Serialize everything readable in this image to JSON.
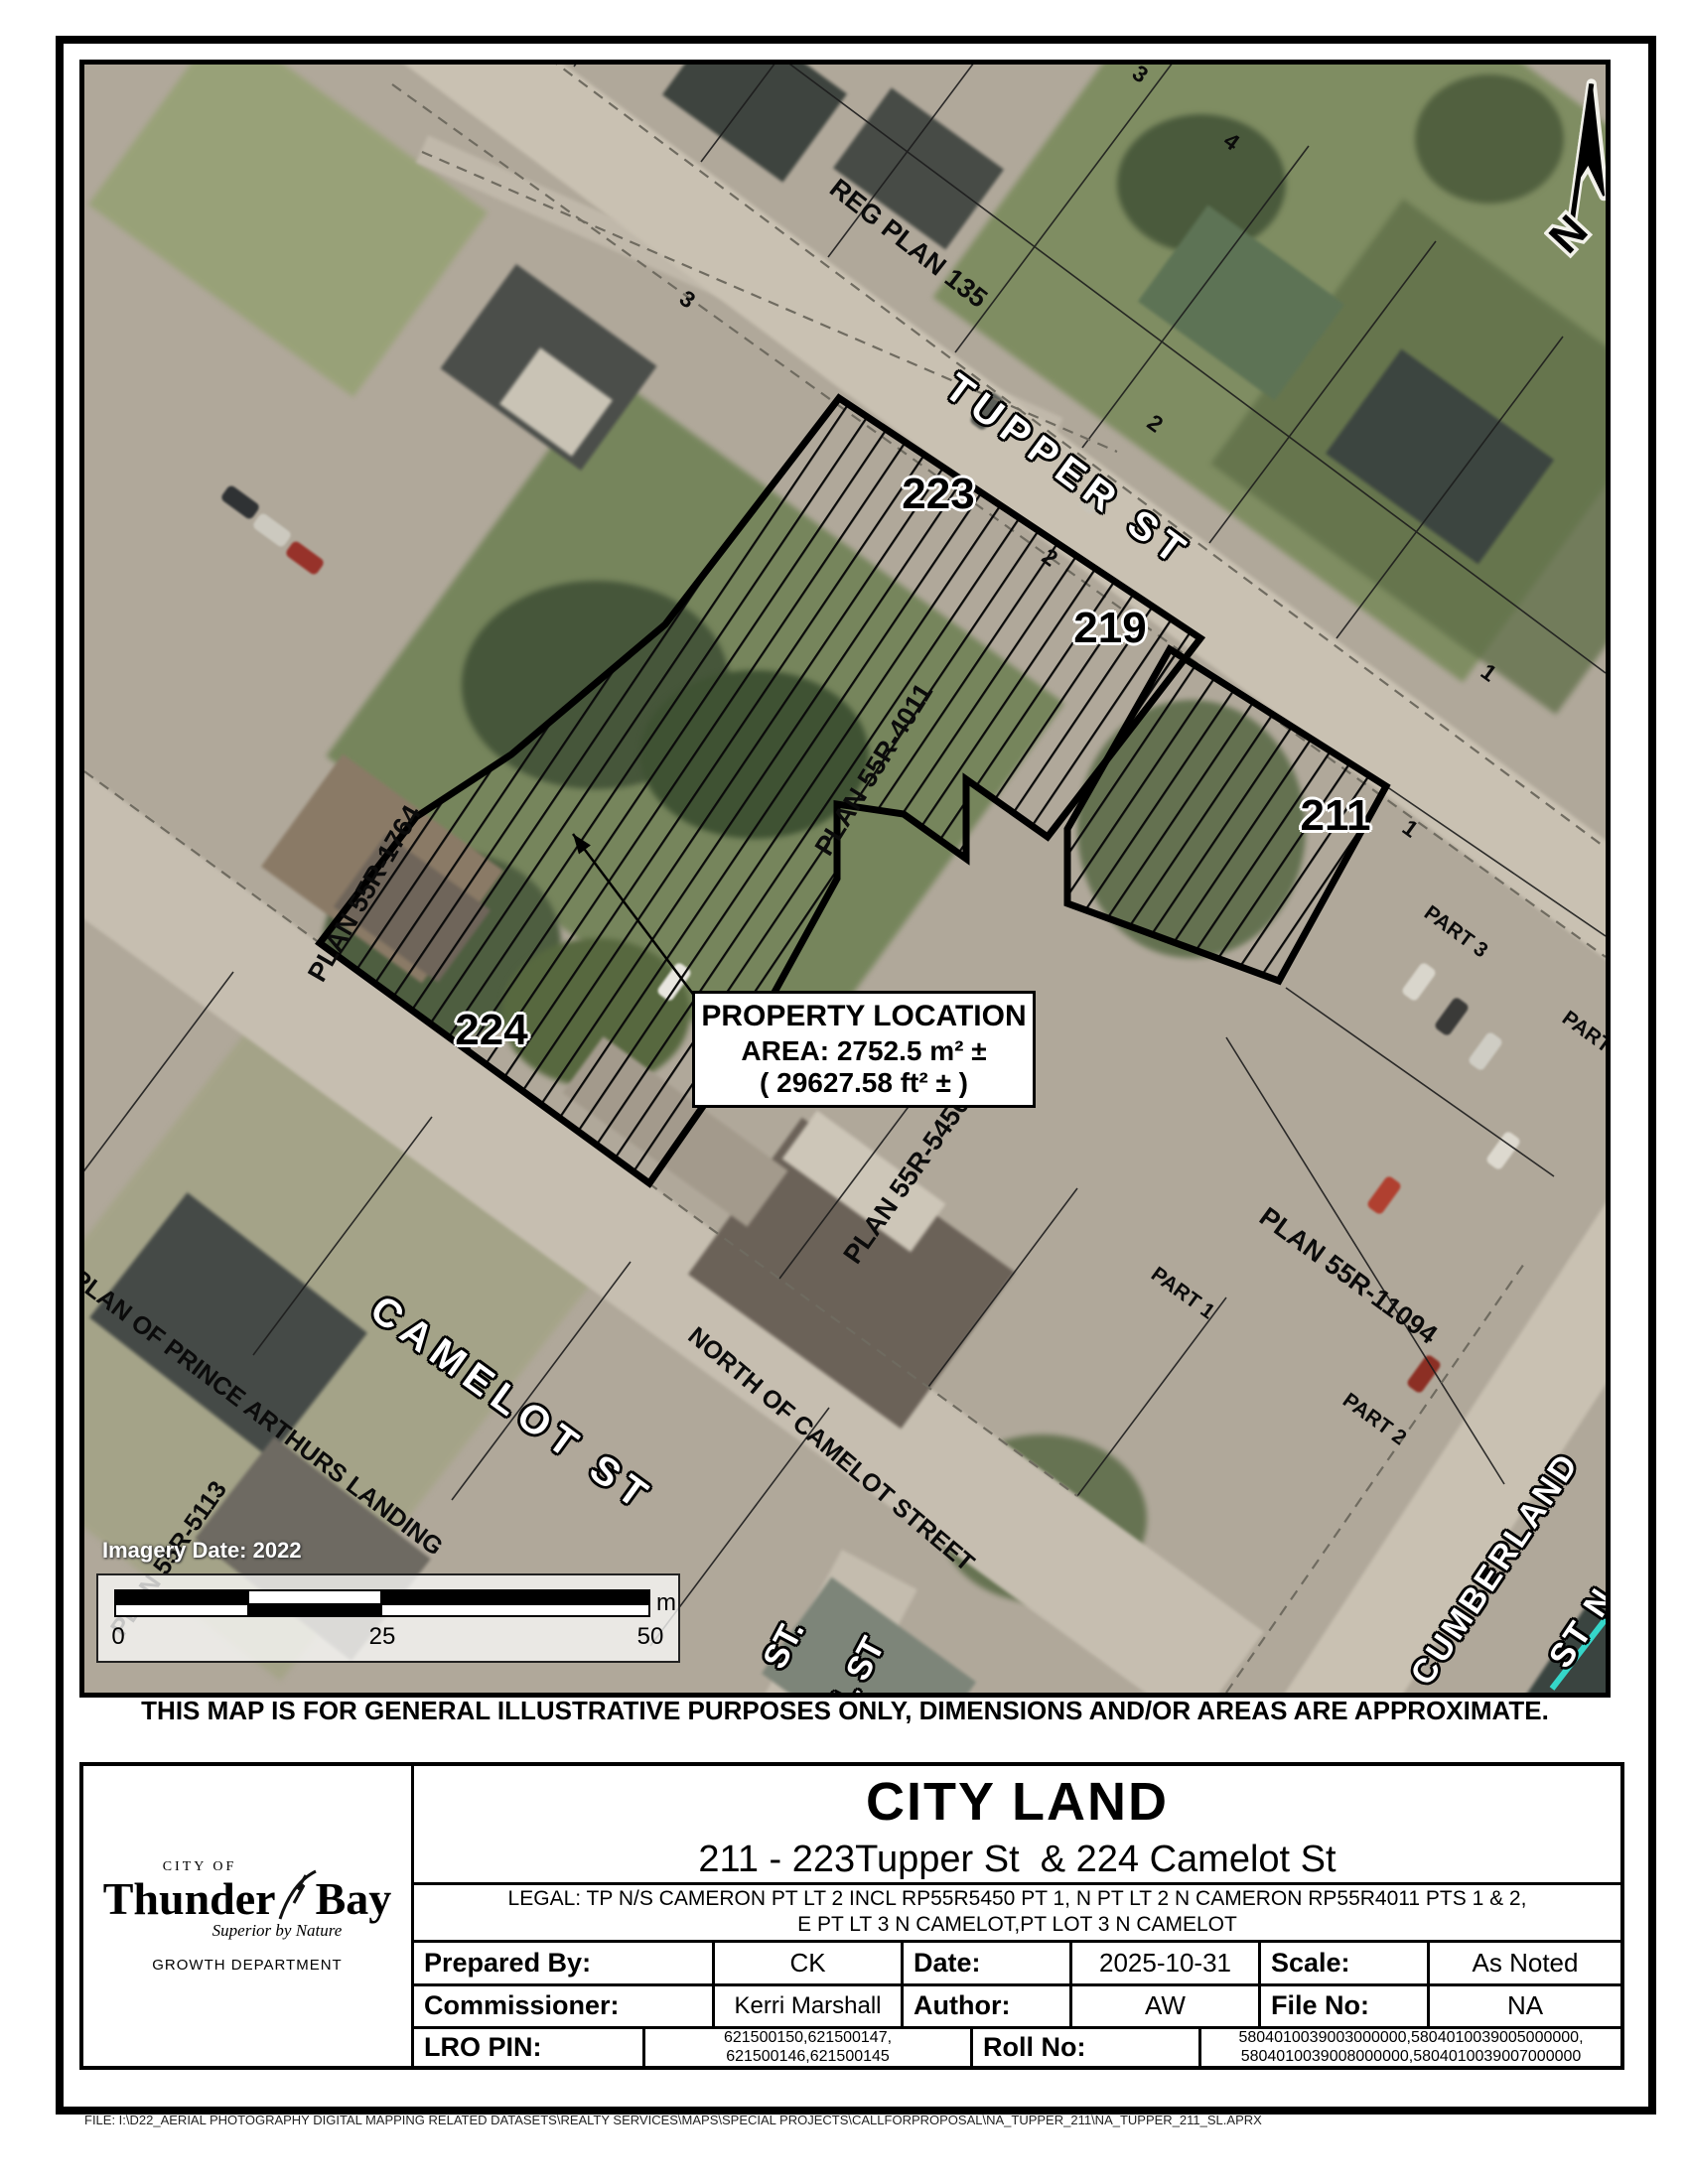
{
  "map": {
    "north_letter": "N",
    "imagery_date": "Imagery Date: 2022",
    "scalebar": {
      "tick0": "0",
      "tick25": "25",
      "tick50": "50",
      "unit": "m"
    },
    "callout": {
      "line1": "PROPERTY LOCATION",
      "line2": "AREA: 2752.5 m² ±",
      "line3": "( 29627.58 ft² ± )"
    },
    "labels": {
      "tupper": "TUPPER ST",
      "camelot": "CAMELOT ST",
      "cumberland_1": "CUMBERLAND",
      "cumberland_2": "ST N",
      "st_dot": "ST.",
      "paul": "PAUL ST",
      "addr_223": "223",
      "addr_219": "219",
      "addr_211": "211",
      "addr_224": "224",
      "reg_plan_135": "REG PLAN 135",
      "plan_4011": "PLAN 55R-4011",
      "plan_1764": "PLAN 55R-1764",
      "plan_5450": "PLAN 55R-5450",
      "plan_11094": "PLAN 55R-11094",
      "plan_5113": "PLAN 55R-5113",
      "north_of_camelot": "NORTH OF CAMELOT STREET",
      "prince_arthurs": "PLAN OF PRINCE ARTHURS LANDING",
      "part1": "PART 1",
      "part2": "PART 2",
      "part3": "PART 3",
      "part4": "PART 4",
      "lot1a": "1",
      "lot1b": "1",
      "lot2a": "2",
      "lot2b": "2",
      "lot3a": "3",
      "lot3b": "3",
      "lot4": "4"
    }
  },
  "disclaimer": "THIS MAP IS FOR GENERAL ILLUSTRATIVE PURPOSES ONLY, DIMENSIONS AND/OR AREAS ARE APPROXIMATE.",
  "title_block": {
    "title": "CITY LAND",
    "subtitle": "211 - 223Tupper St  & 224 Camelot St",
    "legal_line1": "LEGAL: TP N/S CAMERON PT LT 2 INCL RP55R5450 PT 1, N PT LT 2 N CAMERON RP55R4011 PTS 1 & 2,",
    "legal_line2": "E PT LT 3 N CAMELOT,PT LOT 3 N CAMELOT",
    "prepared_by_label": "Prepared By:",
    "prepared_by": "CK",
    "date_label": "Date:",
    "date": "2025-10-31",
    "scale_label": "Scale:",
    "scale": "As Noted",
    "commissioner_label": "Commissioner:",
    "commissioner": "Kerri Marshall",
    "author_label": "Author:",
    "author": "AW",
    "file_no_label": "File No:",
    "file_no": "NA",
    "lro_label": "LRO PIN:",
    "lro_line1": "621500150,621500147,",
    "lro_line2": "621500146,621500145",
    "roll_label": "Roll No:",
    "roll_line1": "5804010039003000000,5804010039005000000,",
    "roll_line2": "5804010039008000000,5804010039007000000"
  },
  "logo": {
    "city_of": "CITY OF",
    "name_left": "Thunder",
    "name_right": "Bay",
    "tagline": "Superior by Nature",
    "department": "GROWTH DEPARTMENT"
  },
  "footer": {
    "file_path": "FILE: I:\\D22_AERIAL PHOTOGRAPHY DIGITAL MAPPING RELATED DATASETS\\REALTY SERVICES\\MAPS\\SPECIAL PROJECTS\\CALLFORPROPOSAL\\NA_TUPPER_211\\NA_TUPPER_211_SL.APRX"
  }
}
